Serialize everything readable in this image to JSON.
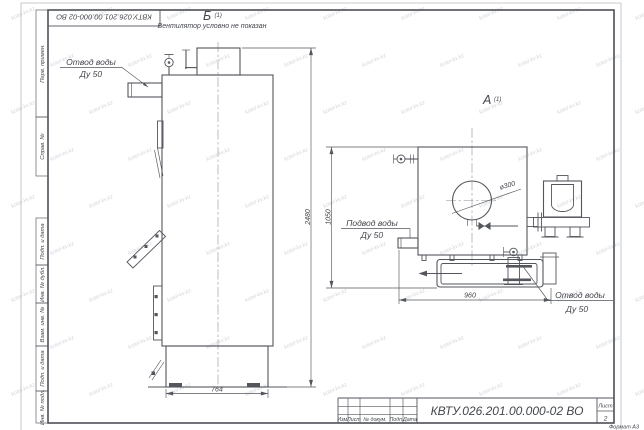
{
  "sheet": {
    "stamp_doc_number": "КВТУ.026.201.00.000-02  ВО",
    "format_note": "Формат А3"
  },
  "frame_labels": {
    "perv_primen": "Перв. примен.",
    "sprav_n": "Справ. №",
    "podp_i_data_top": "Подп. и дата",
    "inv_n_dubl": "Инв. № дубл.",
    "vzam_inv_n": "Взам. инв. №",
    "podp_i_data_bottom": "Подп. и дата",
    "inv_n_podl": "Инв. № подл."
  },
  "title_block": {
    "doc_number": "КВТУ.026.201.00.000-02  ВО",
    "col_izm": "Изм.",
    "col_list": "Лист",
    "col_dokum": "№ докум.",
    "col_podp": "Подп.",
    "col_data": "Дата",
    "sheet_label": "Лист",
    "sheet_number": "2"
  },
  "views": {
    "view_b": {
      "letter": "Б",
      "index": "(1)",
      "note": "Вентилятор условно не показан"
    },
    "view_a": {
      "letter": "А",
      "index": "(1)"
    }
  },
  "labels": {
    "outlet_top": {
      "line1": "Отвод воды",
      "line2": "Ду 50"
    },
    "inlet": {
      "line1": "Подвод воды",
      "line2": "Ду 50"
    },
    "outlet_bottom": {
      "line1": "Отвод воды",
      "line2": "Ду 50"
    },
    "diameter": "ø300"
  },
  "dimensions": {
    "front_total_height": "2480",
    "front_width": "764",
    "side_height": "1050",
    "side_width": "960"
  },
  "watermark": {
    "text": "kotel-kv.kz"
  }
}
